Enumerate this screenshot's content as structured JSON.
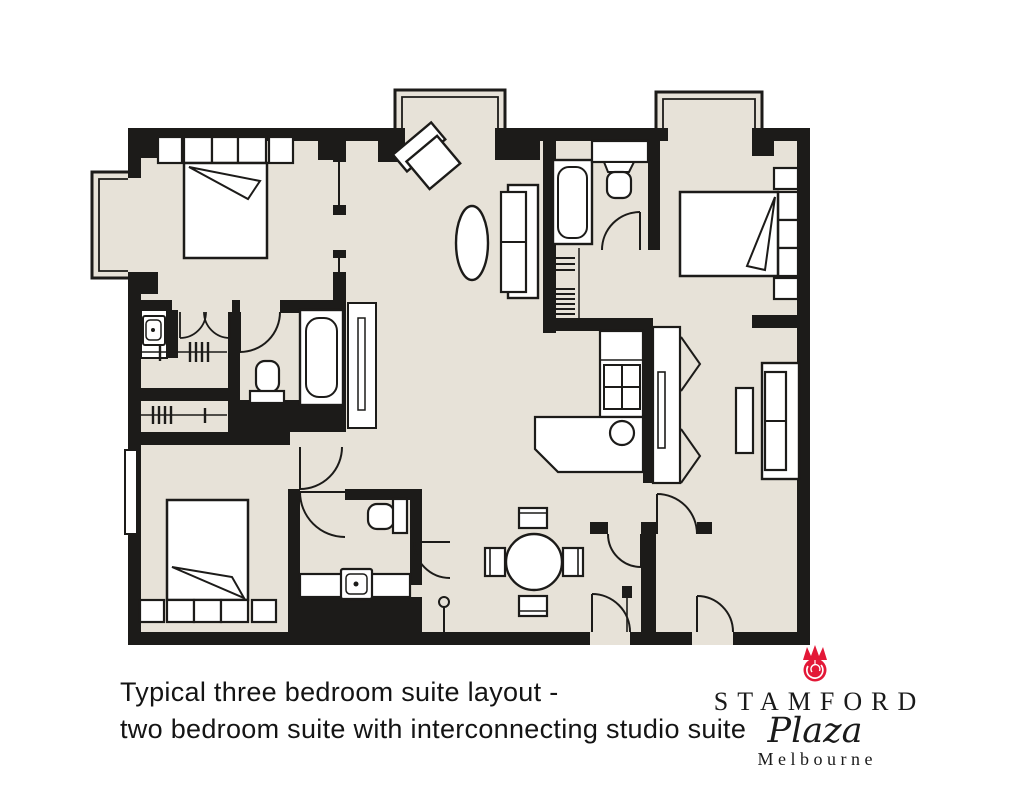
{
  "caption": {
    "line1": "Typical three bedroom suite layout -",
    "line2": "two bedroom suite with interconnecting studio suite"
  },
  "logo": {
    "name": "STAMFORD",
    "script": "Plaza",
    "city": "Melbourne",
    "emblem_icon": "stamford-rose-icon",
    "emblem_color": "#e31837"
  },
  "colors": {
    "floor": "#e7e2d8",
    "wall": "#1c1b19",
    "furniture_fill": "#ffffff",
    "line": "#1c1b19",
    "background": "#ffffff"
  },
  "floor_plan": {
    "type": "hotel-suite-floor-plan",
    "rooms": [
      {
        "name": "bedroom-1",
        "position": "top-left",
        "furniture": [
          "double-bed",
          "bedside-table",
          "bedside-table",
          "headboard",
          "turned-down-sheet",
          "bay-window"
        ]
      },
      {
        "name": "living-room",
        "position": "top-center",
        "furniture": [
          "armchair",
          "oval-coffee-table",
          "sofa",
          "mirror-console",
          "bay-window"
        ]
      },
      {
        "name": "studio-bedroom",
        "position": "top-right",
        "furniture": [
          "double-bed",
          "bedside-table",
          "bedside-table",
          "turned-down-sheet",
          "bay-window"
        ]
      },
      {
        "name": "studio-bathroom",
        "position": "center-top",
        "furniture": [
          "bathtub",
          "vanity-sink",
          "door"
        ]
      },
      {
        "name": "studio-wardrobe",
        "position": "center",
        "furniture": [
          "shelves",
          "hanging-rail"
        ]
      },
      {
        "name": "wardrobe-corridor",
        "position": "middle-left",
        "furniture": [
          "vanity-sink",
          "double-doors",
          "hanging-rail",
          "hanging-rail"
        ]
      },
      {
        "name": "main-bathroom",
        "position": "middle-left",
        "furniture": [
          "toilet",
          "bathtub",
          "door"
        ]
      },
      {
        "name": "bedroom-2",
        "position": "bottom-left",
        "furniture": [
          "double-bed",
          "bedside-table",
          "bedside-table",
          "turned-down-sheet",
          "window"
        ]
      },
      {
        "name": "powder-room",
        "position": "bottom-center",
        "furniture": [
          "toilet",
          "vanity-sink",
          "door"
        ]
      },
      {
        "name": "kitchenette",
        "position": "center",
        "furniture": [
          "cooktop-4-burner",
          "l-shaped-counter",
          "round-sink",
          "cabinet"
        ]
      },
      {
        "name": "dining-area",
        "position": "bottom-center",
        "furniture": [
          "round-dining-table",
          "chair",
          "chair",
          "chair",
          "chair"
        ]
      },
      {
        "name": "studio-living",
        "position": "right",
        "furniture": [
          "tv-cabinet",
          "sofa",
          "coffee-table"
        ]
      },
      {
        "name": "entry",
        "position": "bottom",
        "furniture": [
          "suite-entry-door",
          "studio-entry-door",
          "interconnecting-doors",
          "door-stop"
        ]
      }
    ]
  }
}
